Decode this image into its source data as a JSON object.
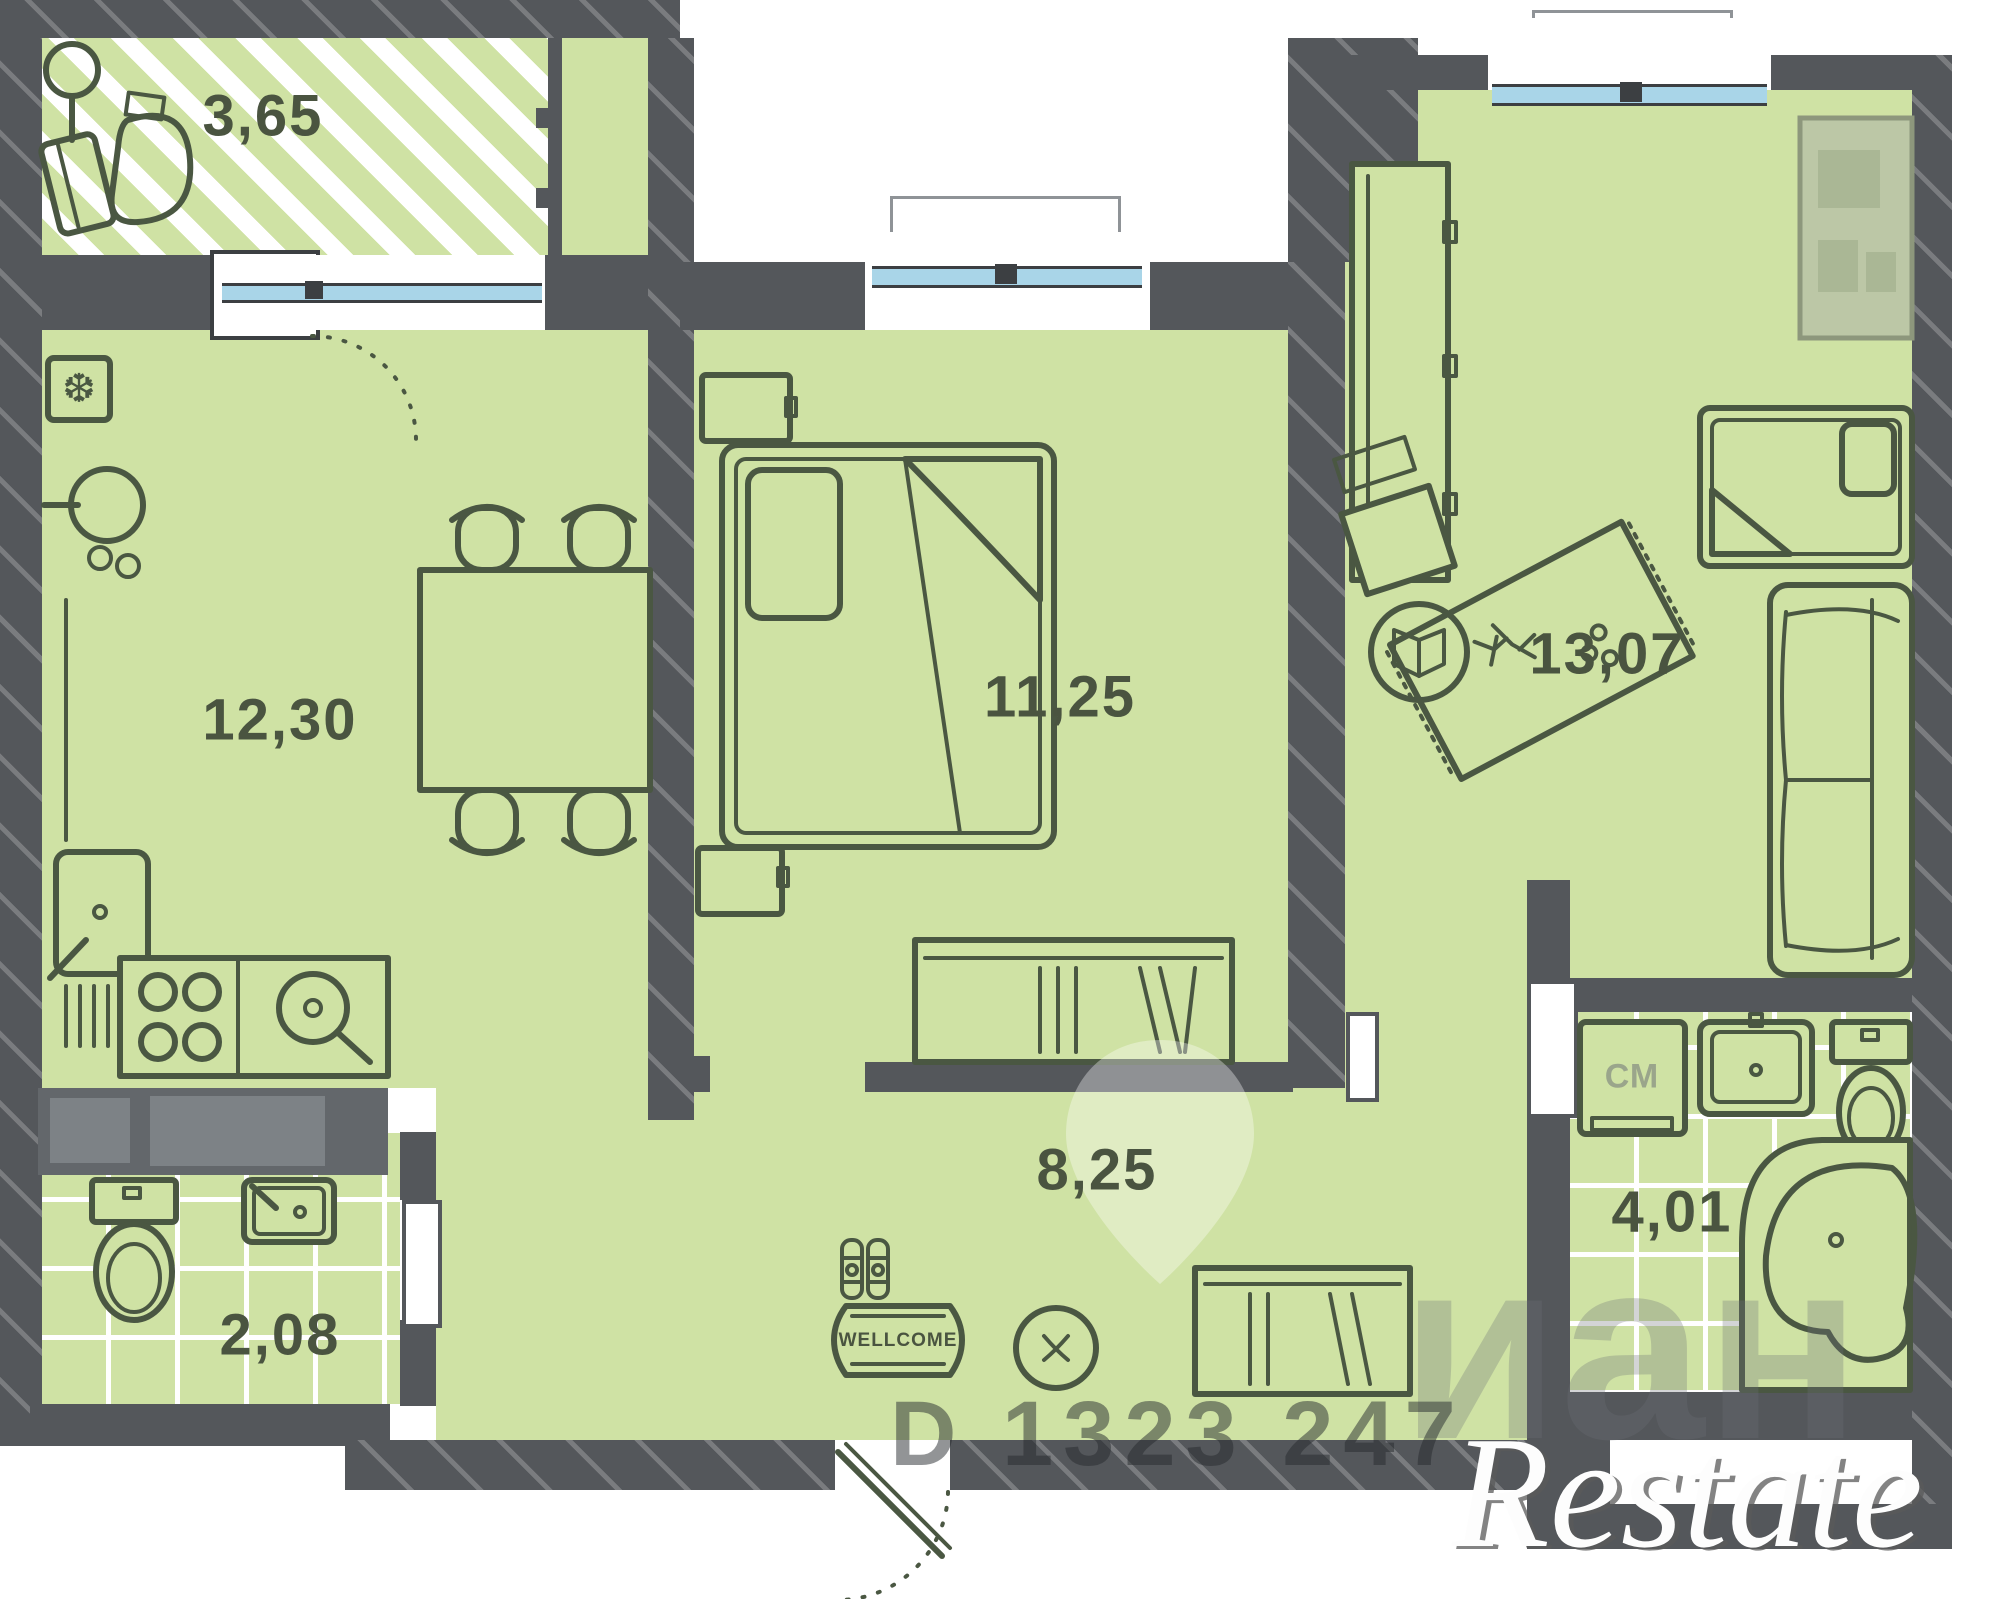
{
  "title": "Apartment floor plan",
  "labels": {
    "balcony": "3,65",
    "kitchen": "12,30",
    "bedroom": "11,25",
    "living": "13,07",
    "hall": "8,25",
    "wc": "2,08",
    "bath": "4,01",
    "washing_machine": "СМ",
    "doormat": "WELLCOME"
  },
  "watermarks": {
    "listing_id": "D 1323 247",
    "cian": "иан",
    "restate": "Restate"
  },
  "colors": {
    "floor_green": "#cfe2a4",
    "wall_dark": "#54575b",
    "glazing_blue": "#a9d5e8",
    "furniture_stroke": "#4a5742",
    "label_text": "#4a5440",
    "tile_line": "#ffffff"
  },
  "icons": {
    "fridge_snowflake": "❆",
    "peephole_cross": "x"
  }
}
